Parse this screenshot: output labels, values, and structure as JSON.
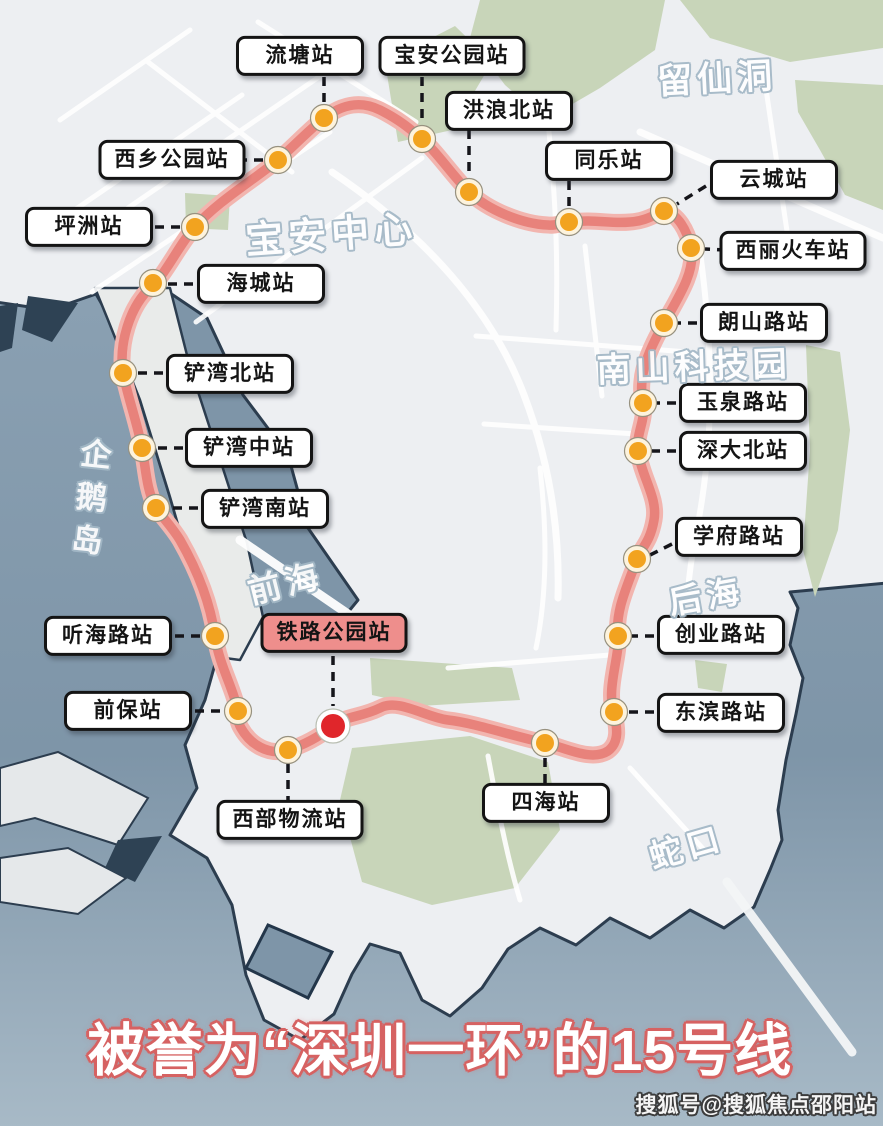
{
  "map": {
    "title": {
      "text": "被誉为“深圳一环”的15号线"
    },
    "watermark": {
      "text": "搜狐号@搜狐焦点邵阳站"
    },
    "colors": {
      "line": "#e8827b",
      "line_halo": "#f2b5af",
      "station_dot": "#f2a31f",
      "station_ring": "#fdf3dd",
      "highlight_dot": "#e0262b",
      "highlight_ring": "#ffffff",
      "highlight_label_bg": "#ee8e8c",
      "label_border": "#141414",
      "water": "#7e95a8",
      "land": "#edeff2",
      "green": "#c8d5b9",
      "title_red": "#d66262"
    },
    "stations": [
      {
        "name": "流塘站",
        "dot": [
          324,
          118
        ],
        "label_center": [
          300,
          56
        ],
        "connector": [
          324,
          77,
          324,
          105
        ],
        "highlight": false
      },
      {
        "name": "宝安公园站",
        "dot": [
          422,
          139
        ],
        "label_center": [
          452,
          56
        ],
        "connector": [
          422,
          77,
          422,
          126
        ],
        "highlight": false
      },
      {
        "name": "洪浪北站",
        "dot": [
          469,
          192
        ],
        "label_center": [
          509,
          111
        ],
        "connector": [
          469,
          130,
          469,
          179
        ],
        "highlight": false
      },
      {
        "name": "同乐站",
        "dot": [
          569,
          222
        ],
        "label_center": [
          609,
          161
        ],
        "connector": [
          569,
          181,
          569,
          209
        ],
        "highlight": false
      },
      {
        "name": "云城站",
        "dot": [
          664,
          211
        ],
        "label_center": [
          774,
          180
        ],
        "connector": [
          706,
          186,
          677,
          204
        ],
        "highlight": false
      },
      {
        "name": "西丽火车站",
        "dot": [
          691,
          248
        ],
        "label_center": [
          793,
          251
        ],
        "connector": [
          726,
          250,
          705,
          249
        ],
        "highlight": false
      },
      {
        "name": "朗山路站",
        "dot": [
          664,
          323
        ],
        "label_center": [
          764,
          323
        ],
        "connector": [
          697,
          323,
          678,
          323
        ],
        "highlight": false
      },
      {
        "name": "玉泉路站",
        "dot": [
          643,
          403
        ],
        "label_center": [
          743,
          403
        ],
        "connector": [
          676,
          403,
          657,
          403
        ],
        "highlight": false
      },
      {
        "name": "深大北站",
        "dot": [
          638,
          451
        ],
        "label_center": [
          743,
          451
        ],
        "connector": [
          676,
          451,
          652,
          451
        ],
        "highlight": false
      },
      {
        "name": "学府路站",
        "dot": [
          637,
          559
        ],
        "label_center": [
          739,
          537
        ],
        "connector": [
          672,
          544,
          650,
          555
        ],
        "highlight": false
      },
      {
        "name": "创业路站",
        "dot": [
          618,
          636
        ],
        "label_center": [
          721,
          635
        ],
        "connector": [
          654,
          636,
          632,
          636
        ],
        "highlight": false
      },
      {
        "name": "东滨路站",
        "dot": [
          614,
          712
        ],
        "label_center": [
          721,
          713
        ],
        "connector": [
          654,
          712,
          628,
          712
        ],
        "highlight": false
      },
      {
        "name": "四海站",
        "dot": [
          545,
          743
        ],
        "label_center": [
          546,
          803
        ],
        "connector": [
          545,
          758,
          545,
          783
        ],
        "highlight": false
      },
      {
        "name": "西部物流站",
        "dot": [
          288,
          750
        ],
        "label_center": [
          290,
          820
        ],
        "connector": [
          288,
          764,
          288,
          800
        ],
        "highlight": false
      },
      {
        "name": "前保站",
        "dot": [
          238,
          711
        ],
        "label_center": [
          128,
          711
        ],
        "connector": [
          195,
          711,
          224,
          711
        ],
        "highlight": false
      },
      {
        "name": "听海路站",
        "dot": [
          215,
          636
        ],
        "label_center": [
          108,
          636
        ],
        "connector": [
          175,
          636,
          201,
          636
        ],
        "highlight": false
      },
      {
        "name": "铁路公园站",
        "dot": [
          333,
          726
        ],
        "label_center": [
          334,
          633
        ],
        "connector": [
          333,
          656,
          333,
          706
        ],
        "highlight": true
      },
      {
        "name": "铲湾南站",
        "dot": [
          156,
          508
        ],
        "label_center": [
          265,
          509
        ],
        "connector": [
          198,
          508,
          170,
          508
        ],
        "highlight": false
      },
      {
        "name": "铲湾中站",
        "dot": [
          142,
          448
        ],
        "label_center": [
          249,
          448
        ],
        "connector": [
          183,
          448,
          156,
          448
        ],
        "highlight": false
      },
      {
        "name": "铲湾北站",
        "dot": [
          123,
          373
        ],
        "label_center": [
          230,
          374
        ],
        "connector": [
          163,
          373,
          137,
          373
        ],
        "highlight": false
      },
      {
        "name": "海城站",
        "dot": [
          153,
          283
        ],
        "label_center": [
          261,
          284
        ],
        "connector": [
          193,
          284,
          167,
          284
        ],
        "highlight": false
      },
      {
        "name": "坪洲站",
        "dot": [
          195,
          227
        ],
        "label_center": [
          89,
          227
        ],
        "connector": [
          155,
          227,
          181,
          227
        ],
        "highlight": false
      },
      {
        "name": "西乡公园站",
        "dot": [
          278,
          160
        ],
        "label_center": [
          172,
          160
        ],
        "connector": [
          238,
          160,
          264,
          160
        ],
        "highlight": false
      }
    ],
    "area_labels": [
      {
        "text": "宝安中心",
        "x": 331,
        "y": 231,
        "size": 38,
        "rot": -4,
        "vertical": false
      },
      {
        "text": "留仙洞",
        "x": 717,
        "y": 76,
        "size": 35,
        "rot": -3,
        "vertical": false
      },
      {
        "text": "南山科技园",
        "x": 694,
        "y": 364,
        "size": 34,
        "rot": -2,
        "vertical": false
      },
      {
        "text": "前海",
        "x": 285,
        "y": 581,
        "size": 33,
        "rot": -14,
        "vertical": false
      },
      {
        "text": "后海",
        "x": 706,
        "y": 594,
        "size": 33,
        "rot": -10,
        "vertical": false
      },
      {
        "text": "蛇口",
        "x": 686,
        "y": 845,
        "size": 33,
        "rot": -16,
        "vertical": false
      },
      {
        "text": "企鹅岛",
        "x": 88,
        "y": 502,
        "size": 31,
        "rot": 6,
        "vertical": true
      }
    ]
  }
}
